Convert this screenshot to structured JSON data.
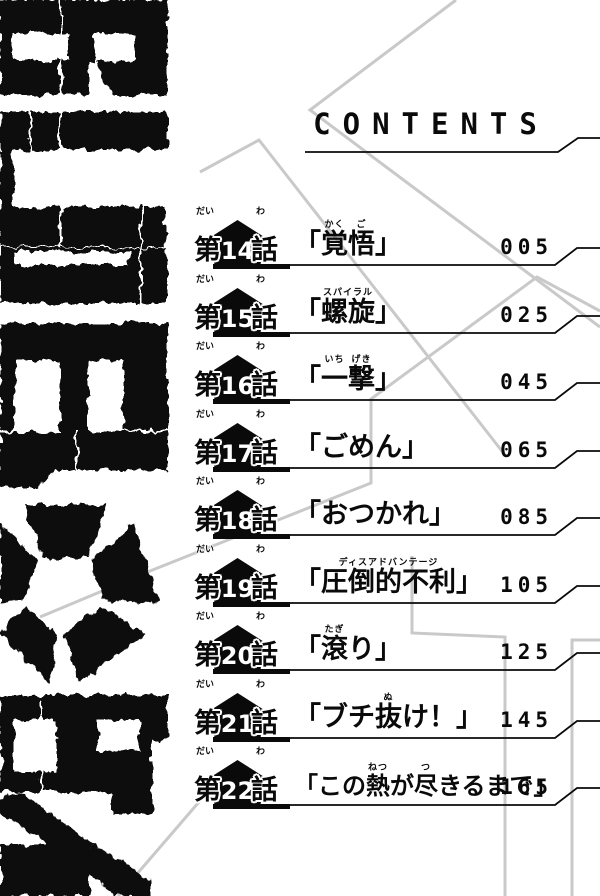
{
  "page": {
    "kind": "manga table of contents",
    "header": "CONTENTS"
  },
  "logo": {
    "text": "BLUELOCK",
    "style": "distressed-vertical-logo"
  },
  "badge": {
    "prefix": "第",
    "prefix_ruby": "だい",
    "suffix": "話",
    "suffix_ruby": "わ"
  },
  "brackets": {
    "open": "「",
    "close": "」"
  },
  "chapters": [
    {
      "number": "14",
      "page": "005",
      "title_segments": [
        {
          "t": "覚",
          "r": "かく"
        },
        {
          "t": "悟",
          "r": "ご"
        }
      ]
    },
    {
      "number": "15",
      "page": "025",
      "title_segments": [
        {
          "t": "螺旋",
          "r": "スパイラル"
        }
      ]
    },
    {
      "number": "16",
      "page": "045",
      "title_segments": [
        {
          "t": "一",
          "r": "いち"
        },
        {
          "t": "撃",
          "r": "げき"
        }
      ]
    },
    {
      "number": "17",
      "page": "065",
      "title_segments": [
        {
          "t": "ごめん"
        }
      ]
    },
    {
      "number": "18",
      "page": "085",
      "title_segments": [
        {
          "t": "おつかれ"
        }
      ]
    },
    {
      "number": "19",
      "page": "105",
      "title_segments": [
        {
          "t": "圧倒的不利",
          "r": "ディスアドバンテージ"
        }
      ]
    },
    {
      "number": "20",
      "page": "125",
      "title_segments": [
        {
          "t": "滾",
          "r": "たぎ"
        },
        {
          "t": "り"
        }
      ]
    },
    {
      "number": "21",
      "page": "145",
      "title_segments": [
        {
          "t": "ブチ"
        },
        {
          "t": "抜",
          "r": "ぬ"
        },
        {
          "t": "け！"
        }
      ]
    },
    {
      "number": "22",
      "page": "165",
      "title_segments": [
        {
          "t": "この"
        },
        {
          "t": "熱",
          "r": "ねつ"
        },
        {
          "t": "が"
        },
        {
          "t": "尽",
          "r": "つ"
        },
        {
          "t": "きるまで"
        }
      ]
    }
  ],
  "colors": {
    "ink": "#0a0a0a",
    "paper": "#ffffff",
    "decor_line": "#c9c9c9"
  }
}
